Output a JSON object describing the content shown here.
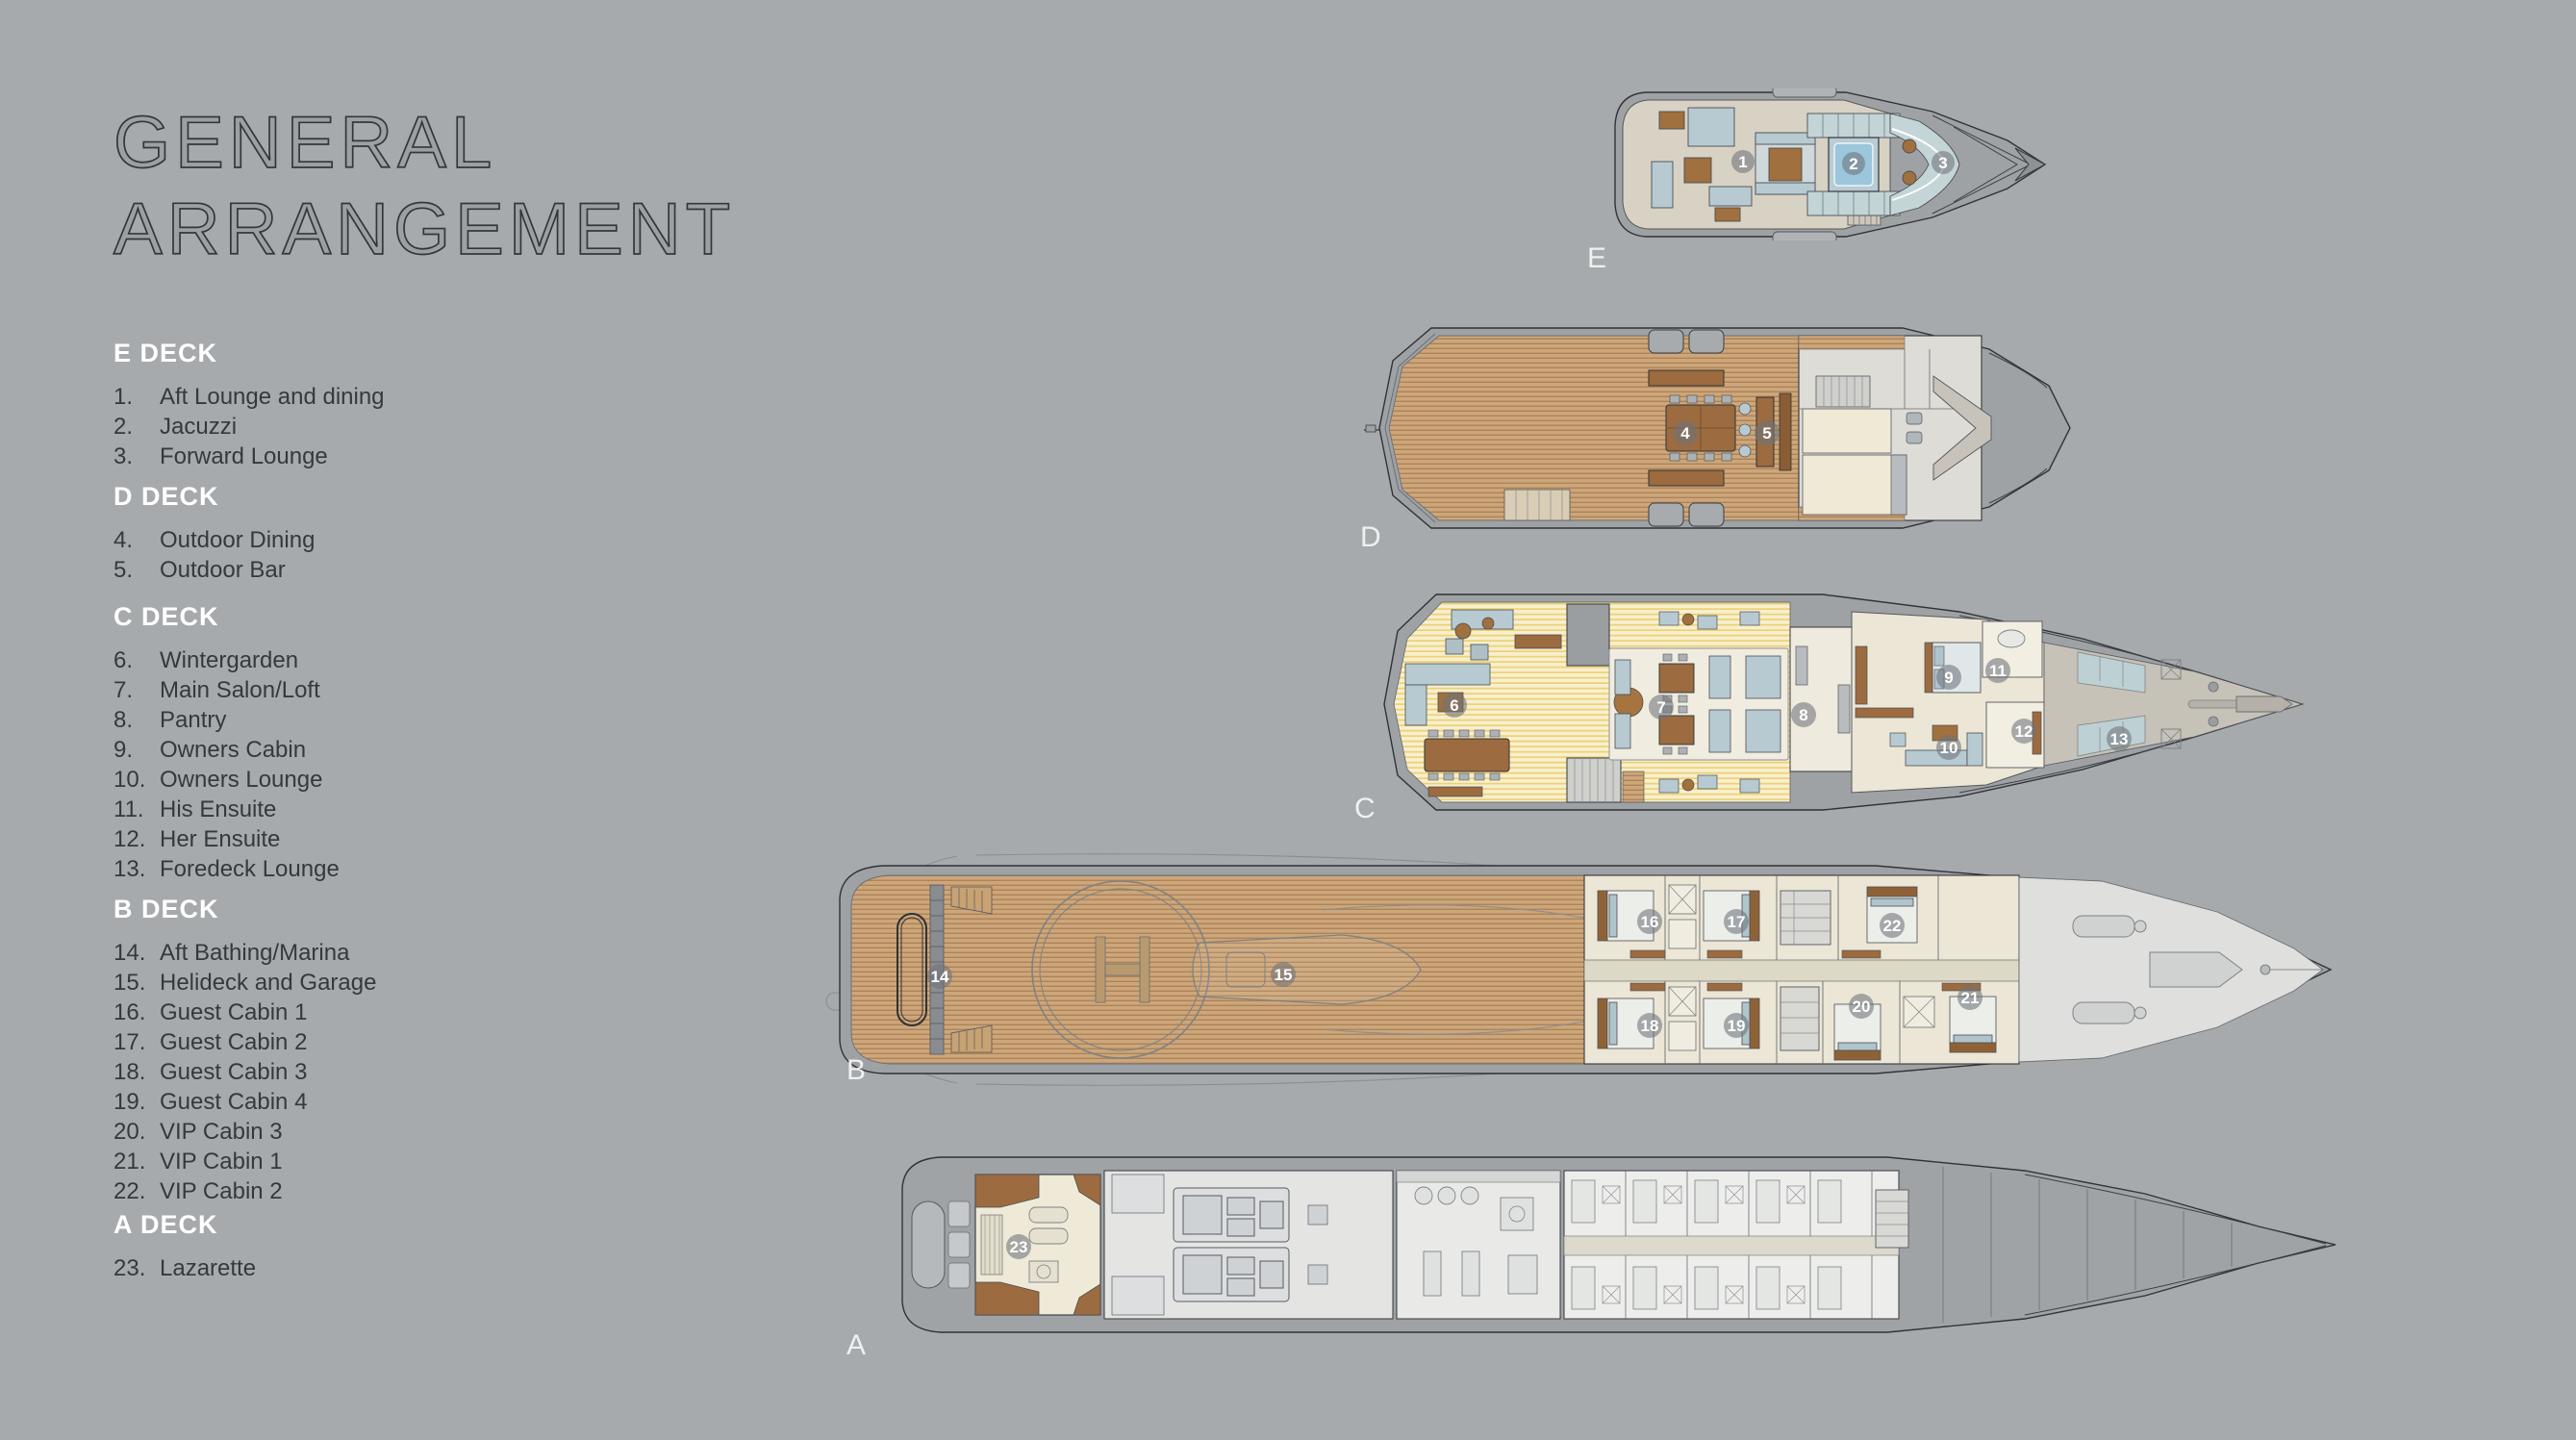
{
  "title": {
    "line1": "GENERAL",
    "line2": "ARRANGEMENT"
  },
  "legend": {
    "sections": [
      {
        "id": "e-deck",
        "heading": "E DECK",
        "items": [
          {
            "num": "1.",
            "label": "Aft Lounge and dining"
          },
          {
            "num": "2.",
            "label": "Jacuzzi"
          },
          {
            "num": "3.",
            "label": "Forward Lounge"
          }
        ]
      },
      {
        "id": "d-deck",
        "heading": "D DECK",
        "items": [
          {
            "num": "4.",
            "label": "Outdoor Dining"
          },
          {
            "num": "5.",
            "label": "Outdoor Bar"
          }
        ]
      },
      {
        "id": "c-deck",
        "heading": "C DECK",
        "items": [
          {
            "num": "6.",
            "label": "Wintergarden"
          },
          {
            "num": "7.",
            "label": "Main Salon/Loft"
          },
          {
            "num": "8.",
            "label": "Pantry"
          },
          {
            "num": "9.",
            "label": "Owners Cabin"
          },
          {
            "num": "10.",
            "label": "Owners Lounge"
          },
          {
            "num": "11.",
            "label": "His Ensuite"
          },
          {
            "num": "12.",
            "label": "Her Ensuite"
          },
          {
            "num": "13.",
            "label": "Foredeck Lounge"
          }
        ]
      },
      {
        "id": "b-deck",
        "heading": "B DECK",
        "items": [
          {
            "num": "14.",
            "label": "Aft Bathing/Marina"
          },
          {
            "num": "15.",
            "label": "Helideck and Garage"
          },
          {
            "num": "16.",
            "label": "Guest Cabin 1"
          },
          {
            "num": "17.",
            "label": "Guest Cabin 2"
          },
          {
            "num": "18.",
            "label": "Guest Cabin 3"
          },
          {
            "num": "19.",
            "label": "Guest Cabin 4"
          },
          {
            "num": "20.",
            "label": "VIP Cabin 3"
          },
          {
            "num": "21.",
            "label": "VIP Cabin 1"
          },
          {
            "num": "22.",
            "label": "VIP Cabin 2"
          }
        ]
      },
      {
        "id": "a-deck",
        "heading": "A DECK",
        "items": [
          {
            "num": "23.",
            "label": "Lazarette"
          }
        ]
      }
    ]
  },
  "decks": {
    "e": {
      "label": "E",
      "markers": {
        "1": "1",
        "2": "2",
        "3": "3"
      }
    },
    "d": {
      "label": "D",
      "markers": {
        "4": "4",
        "5": "5"
      }
    },
    "c": {
      "label": "C",
      "markers": {
        "6": "6",
        "7": "7",
        "8": "8",
        "9": "9",
        "10": "10",
        "11": "11",
        "12": "12",
        "13": "13"
      }
    },
    "b": {
      "label": "B",
      "markers": {
        "14": "14",
        "15": "15",
        "16": "16",
        "17": "17",
        "18": "18",
        "19": "19",
        "20": "20",
        "21": "21",
        "22": "22"
      }
    },
    "a": {
      "label": "A",
      "markers": {
        "23": "23"
      }
    }
  },
  "colors": {
    "background": "#a7aaac",
    "title_text": "#33373c",
    "legend_heading": "#ffffff",
    "legend_text": "#35393e",
    "deck_label": "#eef0f1",
    "teak": "#cda67a",
    "teak_stripe": "#ad835a",
    "yellow_floor": "#f7efcf",
    "yellow_stripe": "#edd173",
    "furniture_blue": "#b7cad1",
    "furniture_brown": "#a0703e",
    "pool_blue": "#9cc6dc",
    "cabin_cream": "#ece6d6",
    "hull_gray": "#9fa2a5",
    "marker_badge": "rgba(110,116,122,0.58)"
  }
}
